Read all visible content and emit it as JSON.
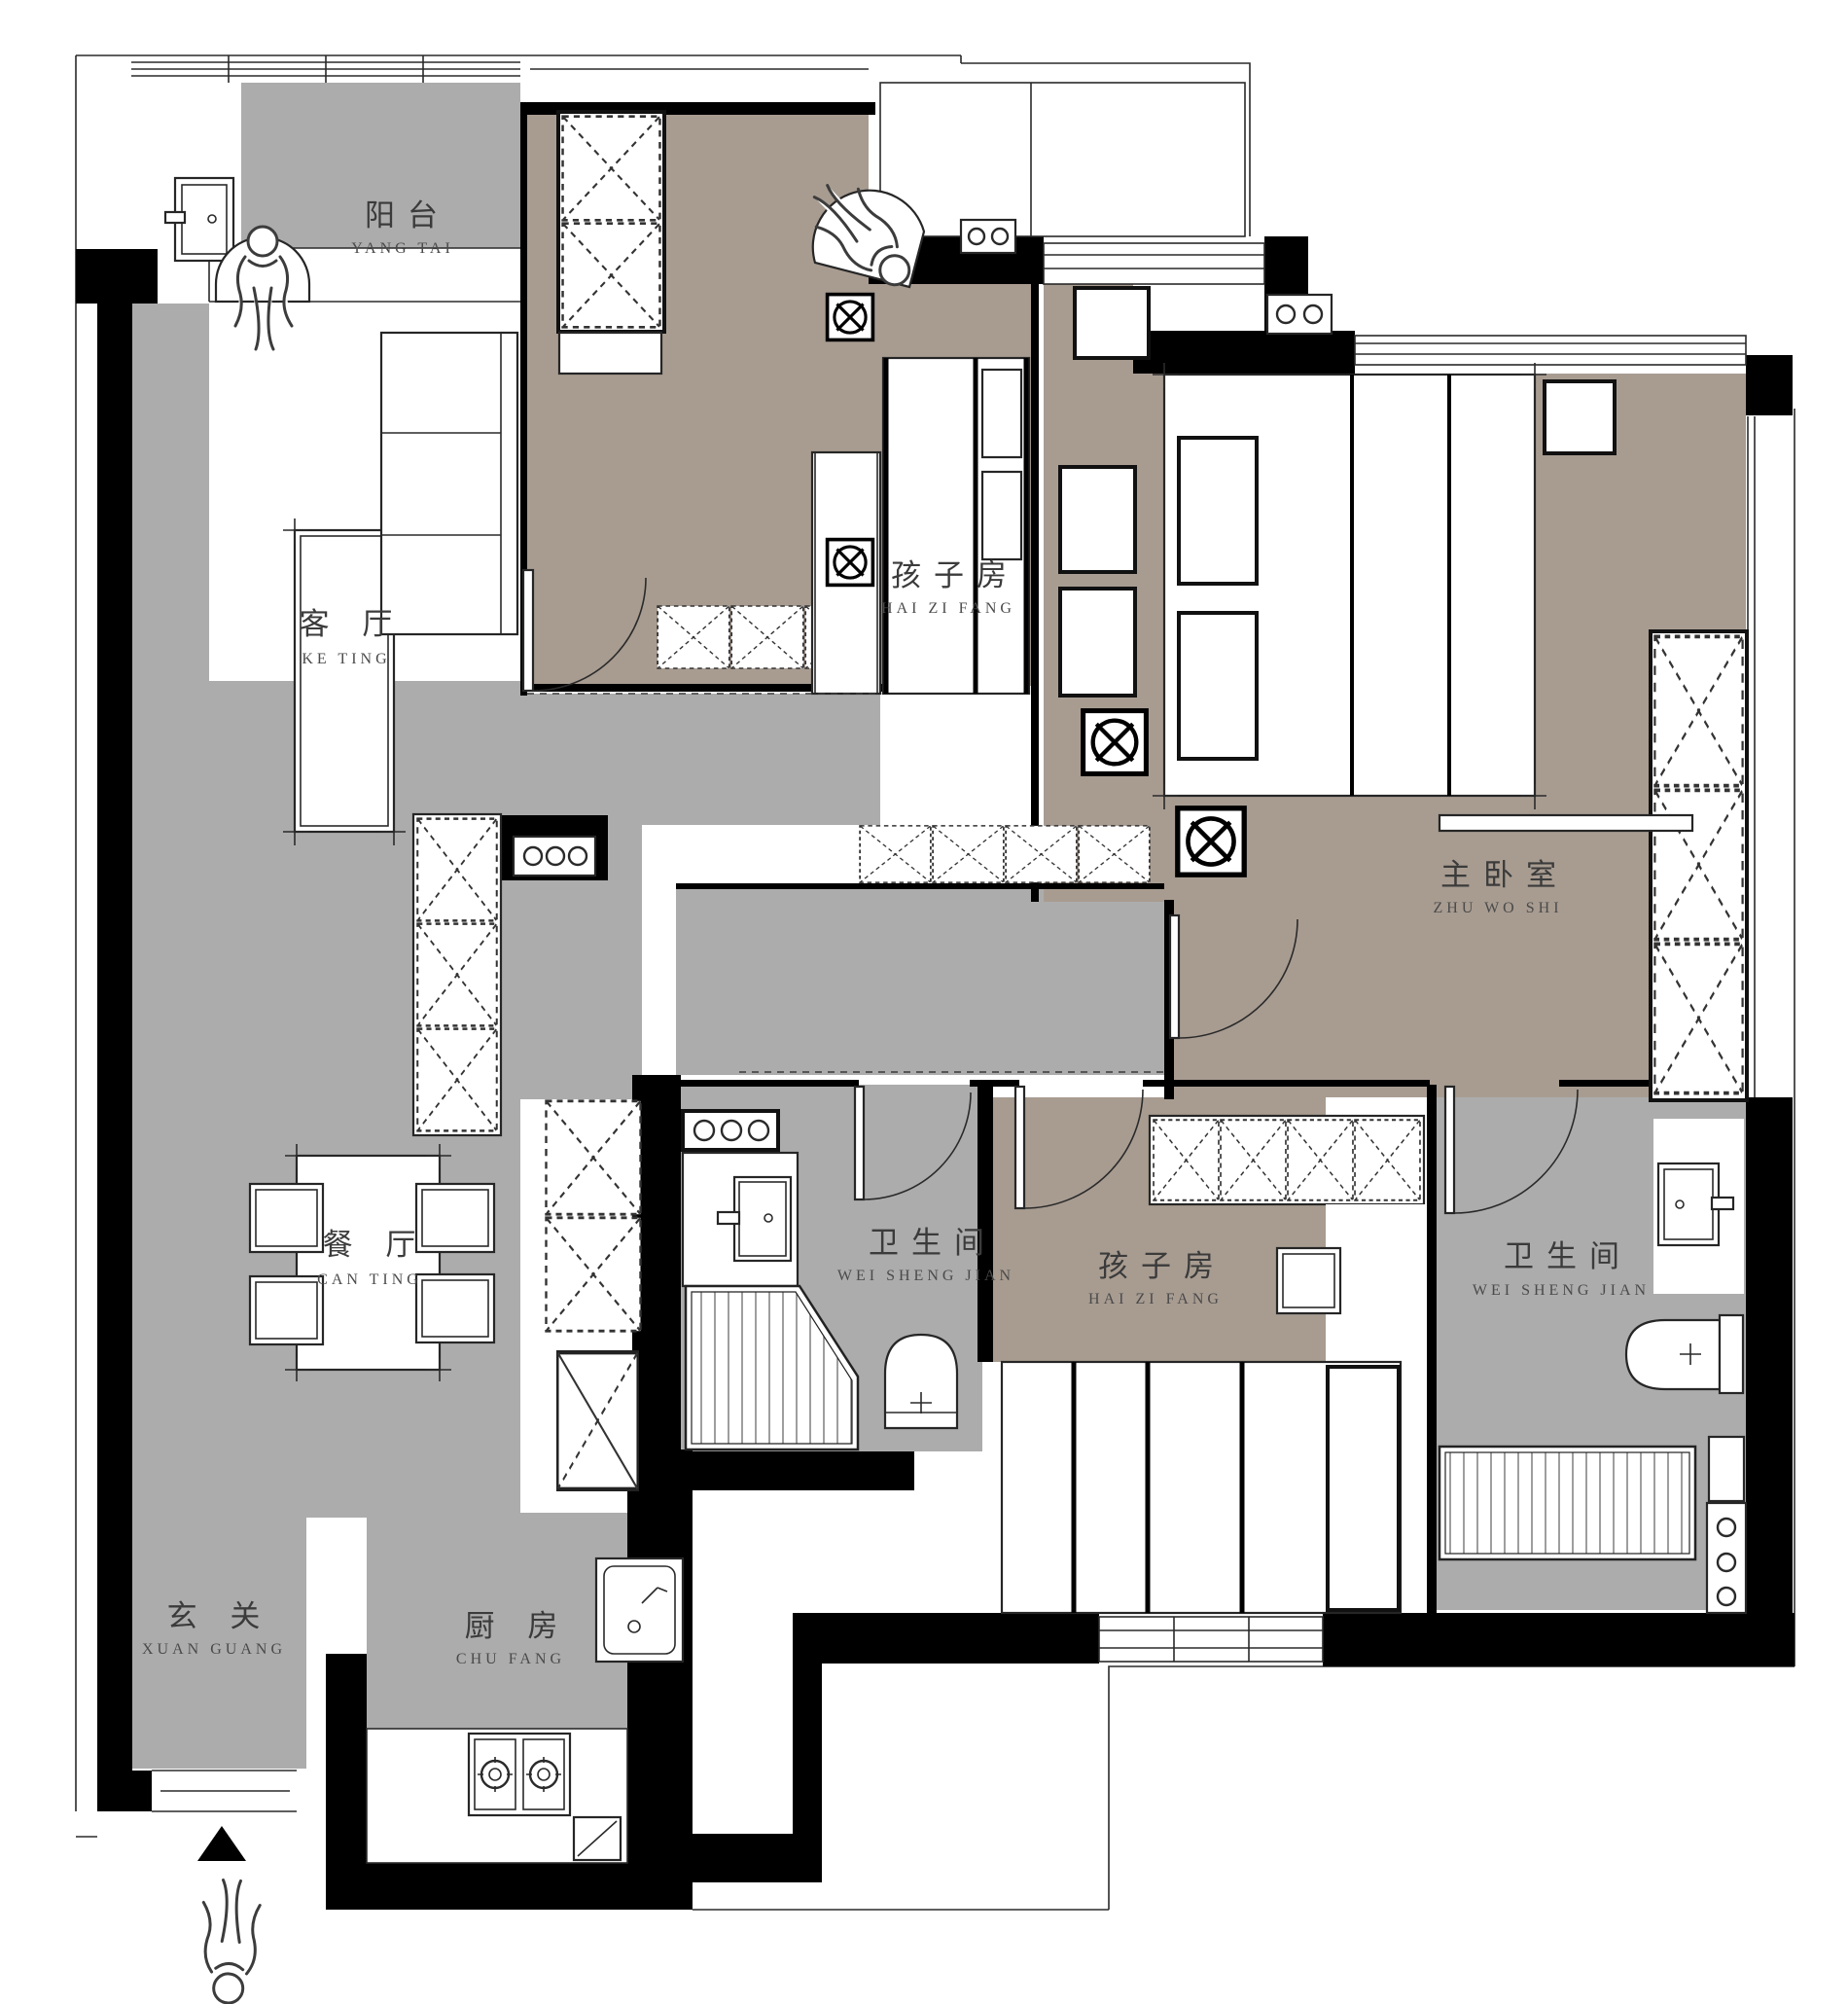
{
  "document": {
    "type": "apartment-floor-plan",
    "language": "zh-CN"
  },
  "colors": {
    "floor_gray": "#ACACAC",
    "floor_taupe": "#A89C91",
    "wall_black": "#000000",
    "background": "#FFFFFF",
    "label_text": "#3B3B3B"
  },
  "rooms": [
    {
      "id": "balcony",
      "name": "阳台",
      "pinyin": "YANG TAI"
    },
    {
      "id": "living-room",
      "name": "客 厅",
      "pinyin": "KE TING"
    },
    {
      "id": "kids-room-1",
      "name": "孩子房",
      "pinyin": "HAI ZI FANG"
    },
    {
      "id": "master-bedroom",
      "name": "主卧室",
      "pinyin": "ZHU WO SHI"
    },
    {
      "id": "bathroom-1",
      "name": "卫生间",
      "pinyin": "WEI SHENG JIAN"
    },
    {
      "id": "dining-room",
      "name": "餐 厅",
      "pinyin": "CAN TING"
    },
    {
      "id": "kids-room-2",
      "name": "孩子房",
      "pinyin": "HAI ZI FANG"
    },
    {
      "id": "bathroom-2",
      "name": "卫生间",
      "pinyin": "WEI SHENG JIAN"
    },
    {
      "id": "entry",
      "name": "玄 关",
      "pinyin": "XUAN GUANG"
    },
    {
      "id": "kitchen",
      "name": "厨 房",
      "pinyin": "CHU FANG"
    }
  ],
  "icons": [
    {
      "id": "washing-machine-icon",
      "meaning": "washing machine on balcony"
    },
    {
      "id": "ceiling-fixture-icon",
      "meaning": "circle with X in square - light/fan fixture",
      "count": 4
    },
    {
      "id": "wardrobe-x-icon",
      "meaning": "dashed crossed boxes - wardrobes and cabinets"
    },
    {
      "id": "stove-icon",
      "meaning": "two burner gas cooktop"
    },
    {
      "id": "sink-icon",
      "meaning": "kitchen and bathroom sinks"
    },
    {
      "id": "toilet-icon",
      "meaning": "toilets in both bathrooms",
      "count": 2
    },
    {
      "id": "shower-icon",
      "meaning": "striped shower floor areas",
      "count": 2
    },
    {
      "id": "entrance-arrow-icon",
      "meaning": "black triangle entrance direction marker"
    },
    {
      "id": "person-figure-icon",
      "meaning": "human figures",
      "count": 3
    }
  ]
}
